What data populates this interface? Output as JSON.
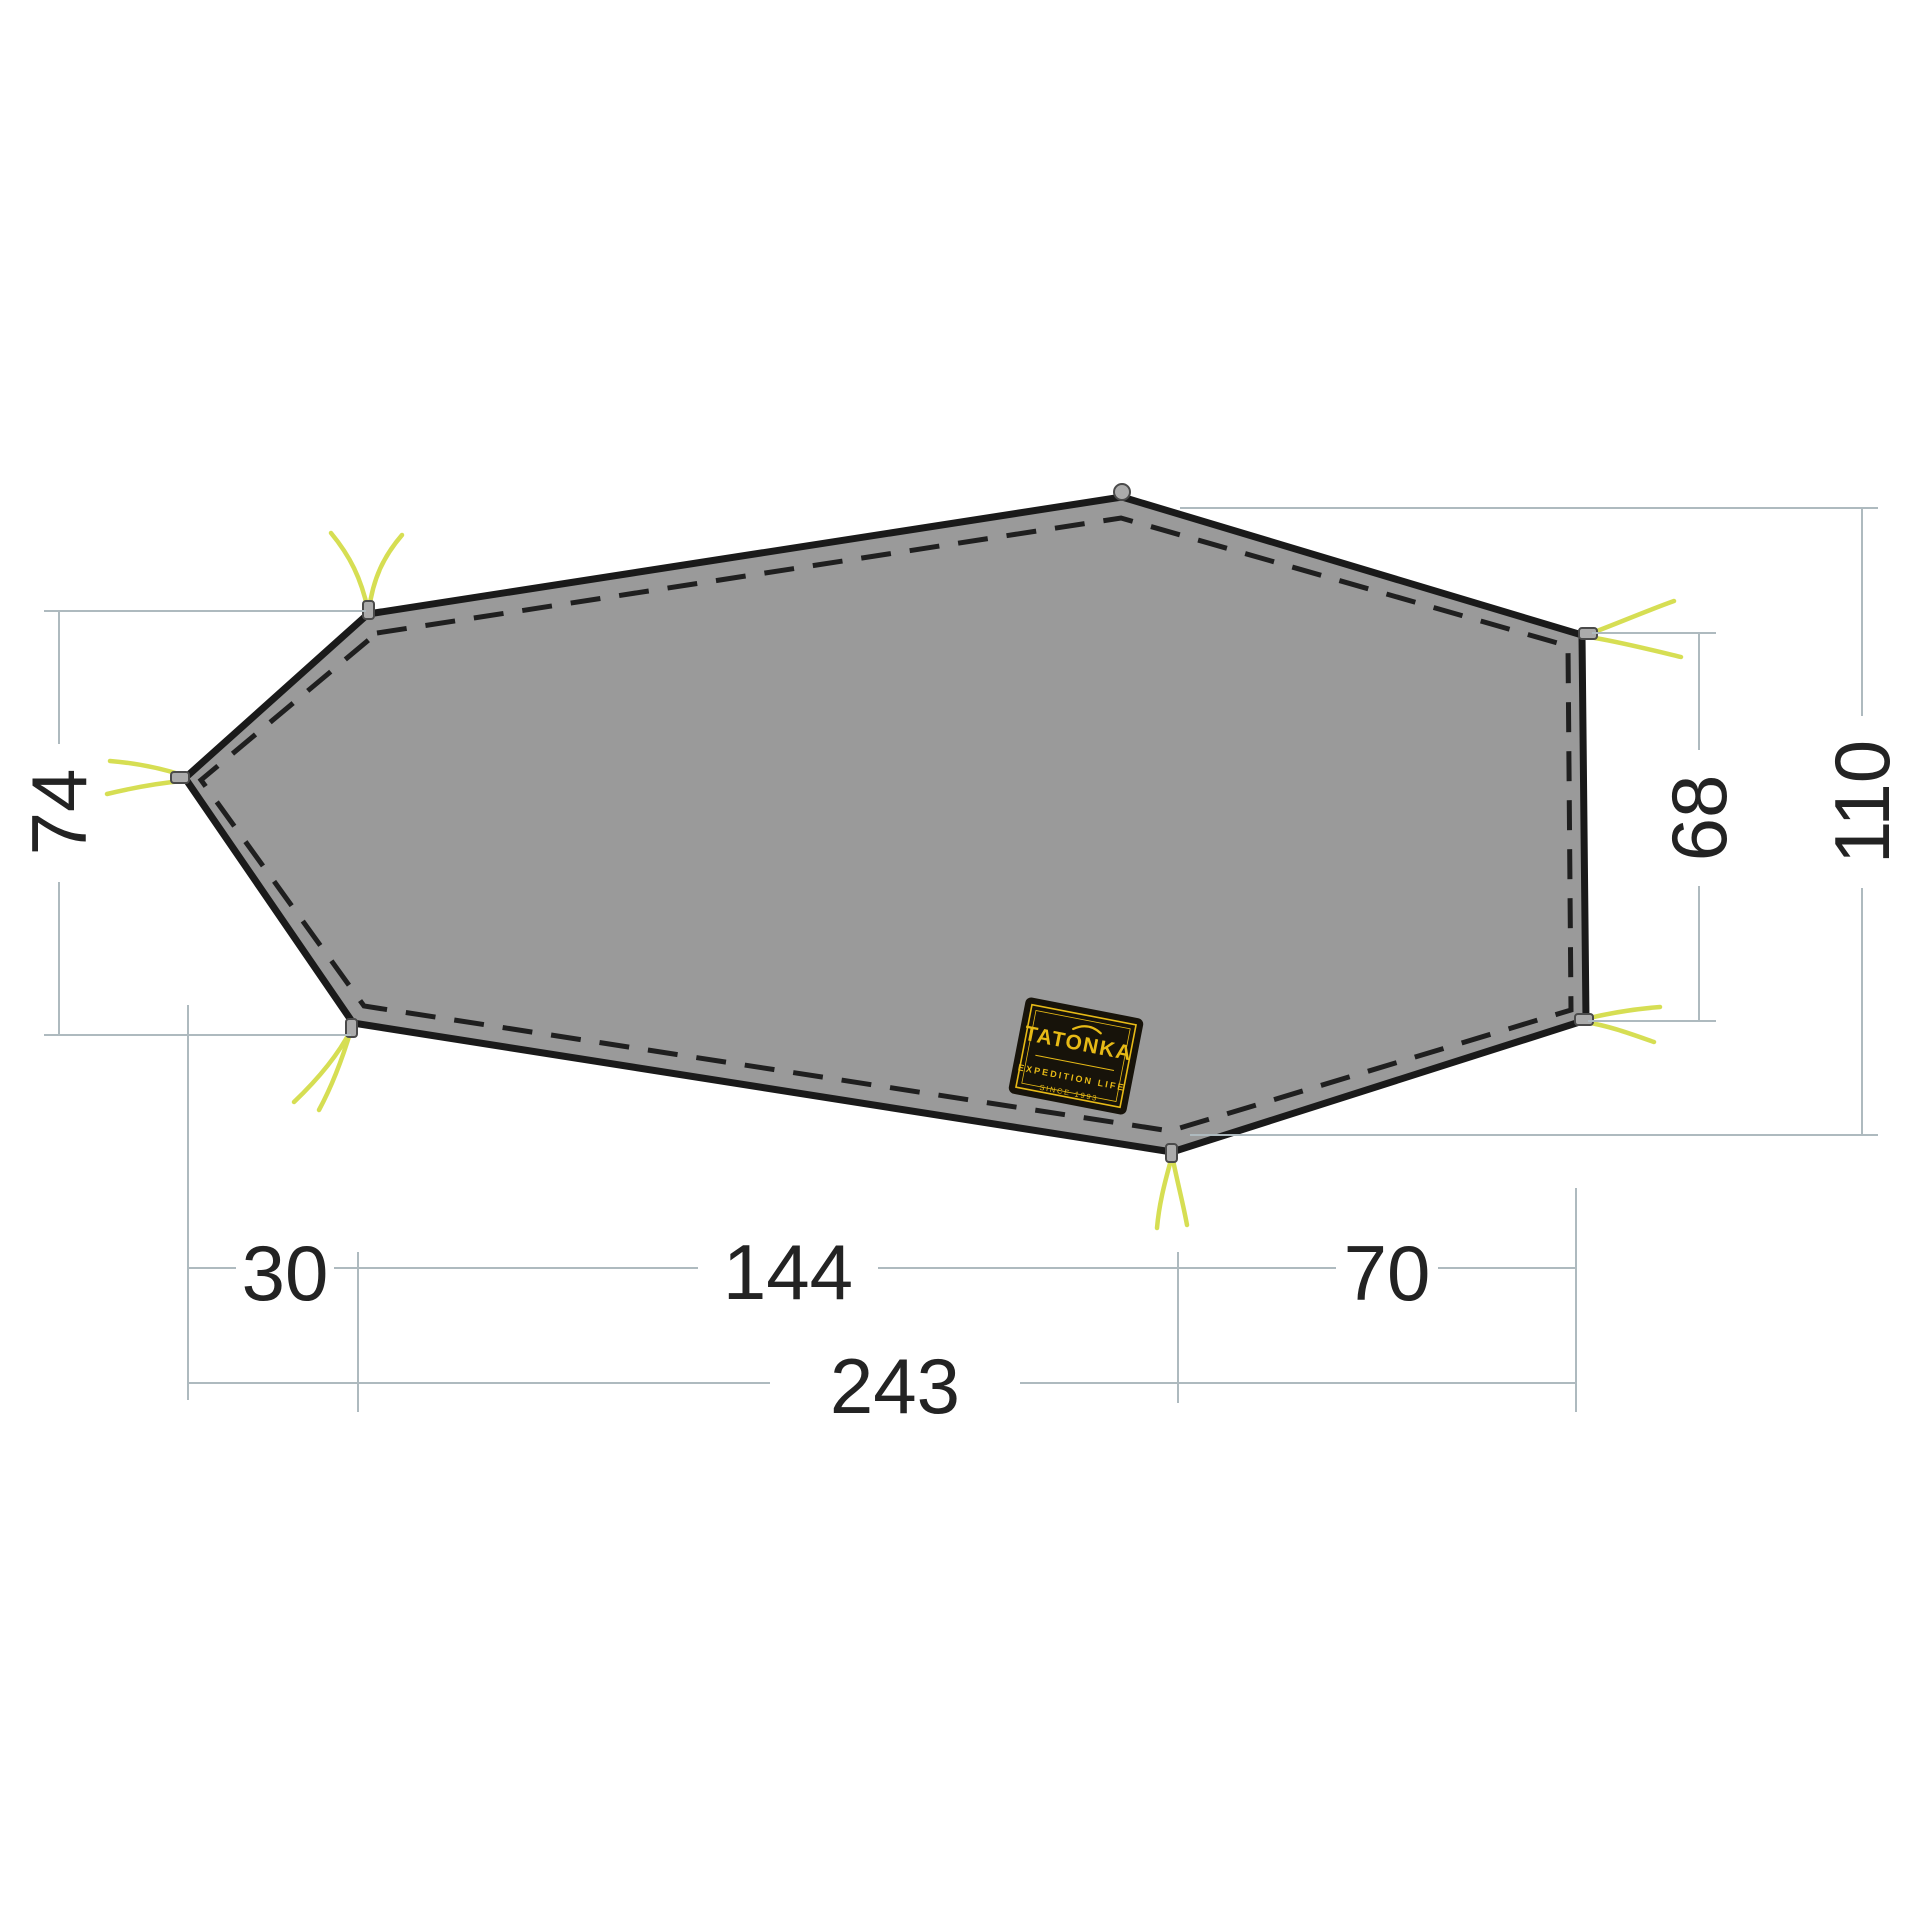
{
  "dimensions": {
    "left_height": "74",
    "right_edge_height": "68",
    "right_total_height": "110",
    "bottom_left_offset": "30",
    "bottom_middle_length": "144",
    "bottom_right_length": "70",
    "bottom_total_length": "243"
  },
  "brand_patch": {
    "brand": "TATONKA",
    "line1": "EXPEDITION LIFE",
    "line2": "SINCE 1993"
  },
  "colors": {
    "background": "#ffffff",
    "fabric": "#9a9a9a",
    "outline": "#1a1a1a",
    "seam": "#1f1f1f",
    "guyline": "#d6de53",
    "grommet": "#ababab",
    "grommet_edge": "#4a4a4a",
    "dimension_line": "#aebabf",
    "dimension_text": "#232323",
    "label_bg": "#17130a",
    "label_accent": "#e7ba16"
  }
}
